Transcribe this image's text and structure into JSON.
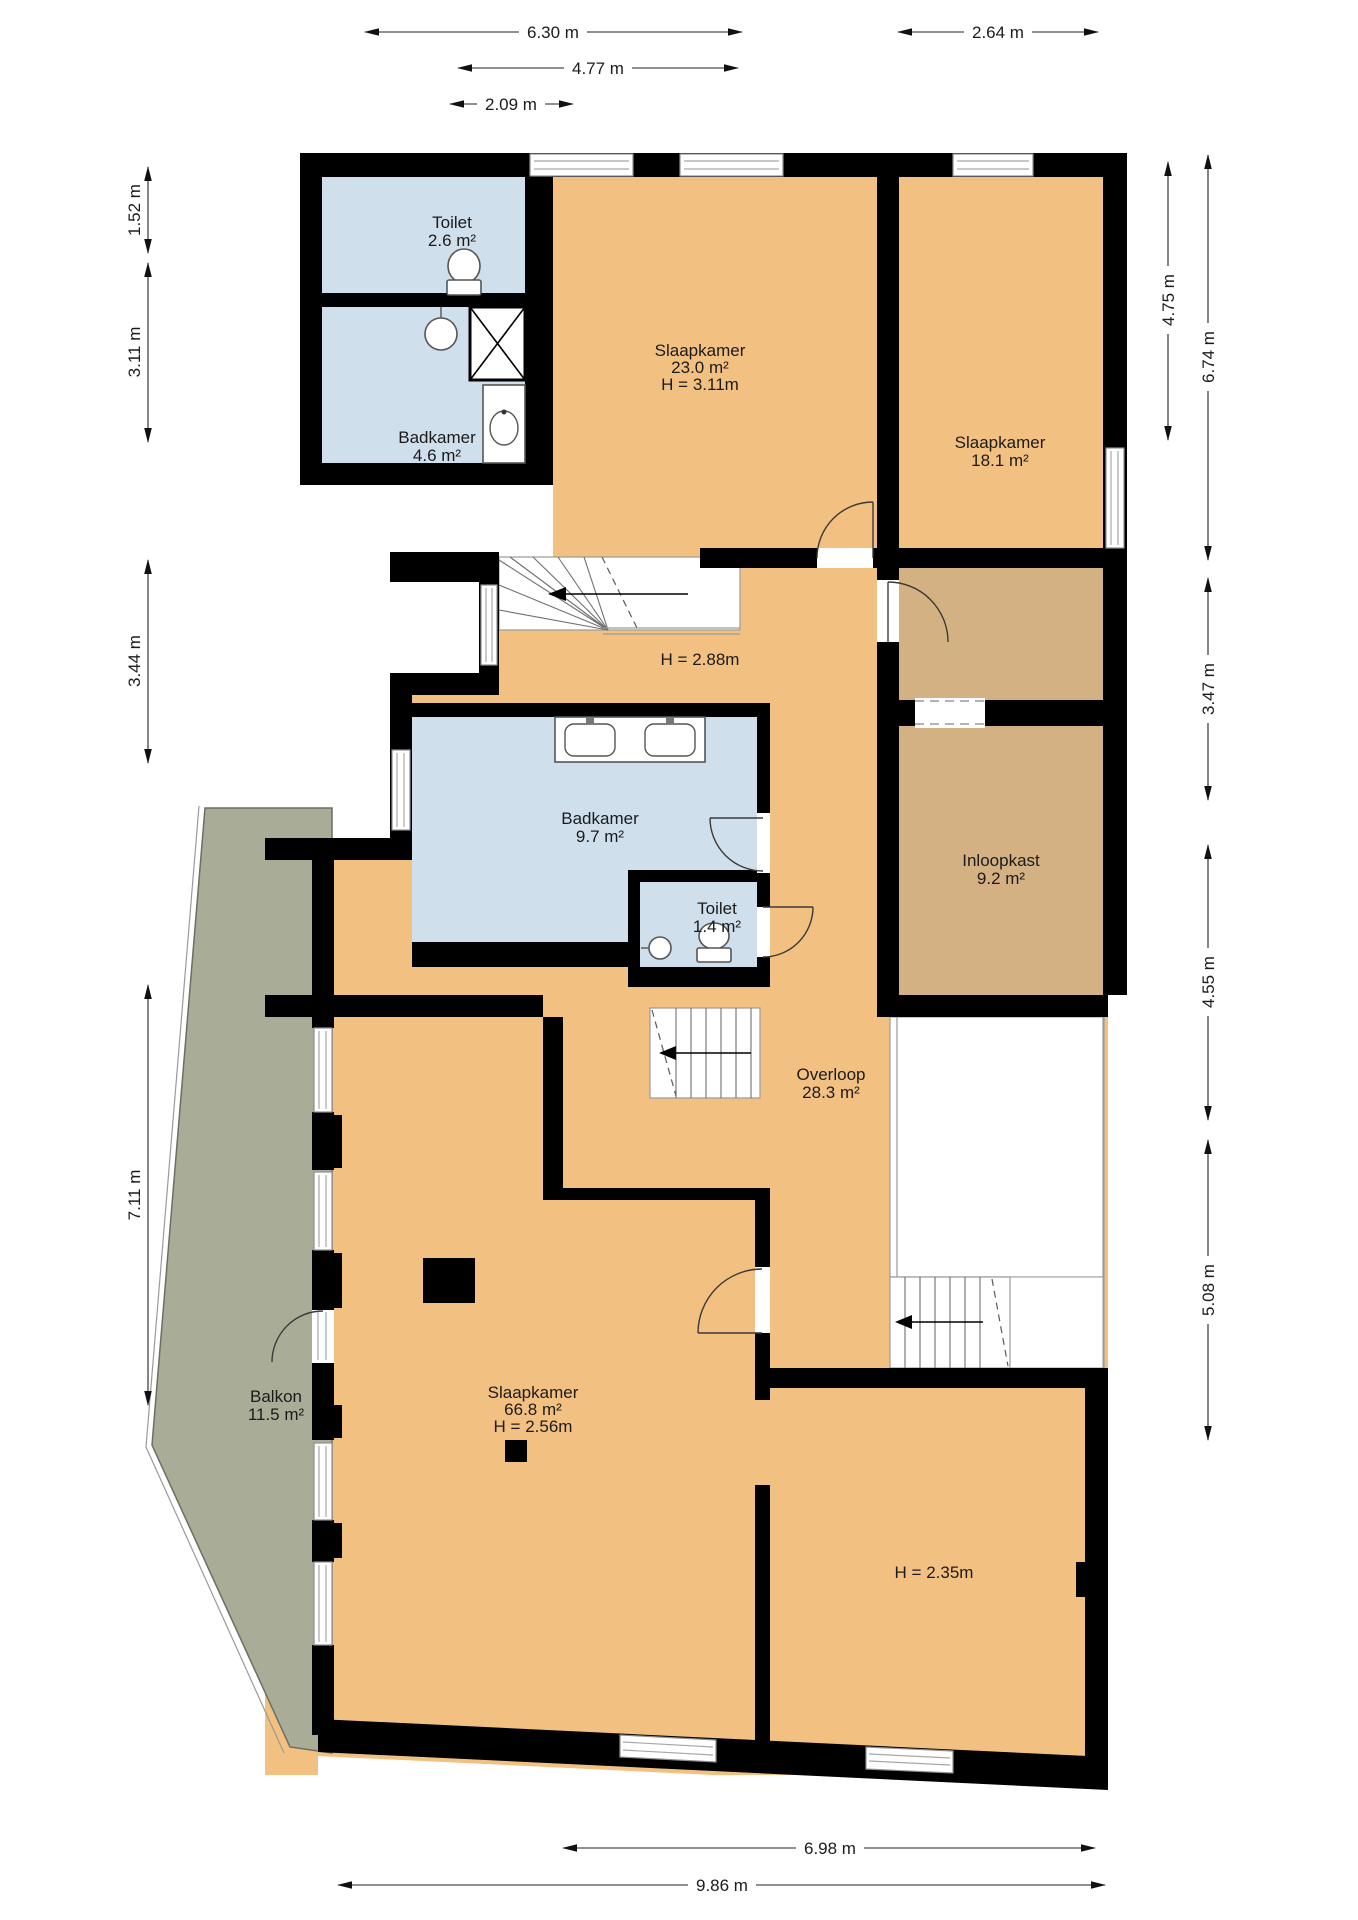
{
  "colors": {
    "room": "#f2c182",
    "closet": "#d3b183",
    "wet": "#d0dfec",
    "balcony": "#a9ad97",
    "wall": "#000000"
  },
  "rooms": [
    {
      "id": "toilet-top",
      "name": "Toilet",
      "area": "2.6 m²"
    },
    {
      "id": "badkamer-top",
      "name": "Badkamer",
      "area": "4.6 m²"
    },
    {
      "id": "slaapkamer-23",
      "name": "Slaapkamer",
      "area": "23.0 m²",
      "height": "H = 3.11m"
    },
    {
      "id": "slaapkamer-18",
      "name": "Slaapkamer",
      "area": "18.1 m²"
    },
    {
      "id": "landing-height",
      "height": "H = 2.88m"
    },
    {
      "id": "badkamer-97",
      "name": "Badkamer",
      "area": "9.7 m²"
    },
    {
      "id": "toilet-14",
      "name": "Toilet",
      "area": "1.4 m²"
    },
    {
      "id": "inloopkast",
      "name": "Inloopkast",
      "area": "9.2 m²"
    },
    {
      "id": "overloop",
      "name": "Overloop",
      "area": "28.3 m²"
    },
    {
      "id": "balkon",
      "name": "Balkon",
      "area": "11.5 m²"
    },
    {
      "id": "slaapkamer-668",
      "name": "Slaapkamer",
      "area": "66.8 m²",
      "height": "H = 2.56m"
    },
    {
      "id": "lowroom-height",
      "height": "H = 2.35m"
    }
  ],
  "dimensions": {
    "top": [
      "6.30 m",
      "2.64 m",
      "4.77 m",
      "2.09 m"
    ],
    "left": [
      "1.52 m",
      "3.11 m",
      "3.44 m",
      "7.11 m"
    ],
    "right": [
      "4.75 m",
      "6.74 m",
      "3.47 m",
      "4.55 m",
      "5.08 m"
    ],
    "bottom": [
      "6.98 m",
      "9.86 m"
    ]
  }
}
